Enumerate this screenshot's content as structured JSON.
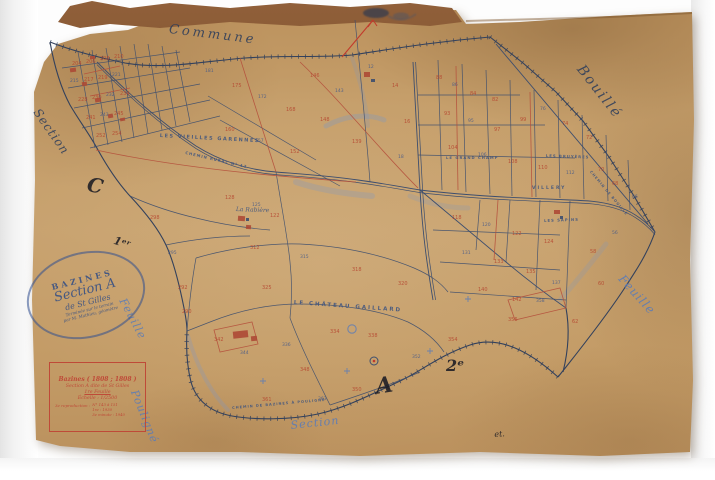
{
  "colors": {
    "paper": "#c49e6a",
    "ink_blue": "#2e3e5c",
    "parcel_blue": "#3d4e6e",
    "ink_red": "#b5503c",
    "pencil_blue": "#5b7cb8",
    "stamp_blue": "#2f4f8f",
    "box_red": "#bf4a38"
  },
  "stamp": {
    "lines": [
      "BAZINES",
      "Section A",
      "de St Gilles",
      "Terminée sur le terrain",
      "par M. Mathieu, géomètre"
    ]
  },
  "cartouche": {
    "line1": "Bazines ( 1808 ; 1808 )",
    "line2": "Section A dite de St Gilles",
    "line3": "1re Feuille",
    "line4": "Échelle : 1/2500",
    "repro_label": "3e reproduction :",
    "repro_lines": [
      "N° 143 à 151",
      "1re : 1930",
      "3e minute : 1940"
    ]
  },
  "map": {
    "labels": [
      {
        "id": "commune",
        "t": "Commune",
        "x": 170,
        "y": 22,
        "r": 7,
        "s": 13,
        "ls": 3,
        "c": "ink",
        "st": "script"
      },
      {
        "id": "bouille",
        "t": "Bouillé",
        "x": 586,
        "y": 62,
        "r": 52,
        "s": 14,
        "ls": 2,
        "c": "ink",
        "st": "script"
      },
      {
        "id": "feuille-right",
        "t": "Feuille",
        "x": 626,
        "y": 272,
        "r": 48,
        "s": 12,
        "ls": 1,
        "c": "pencil",
        "st": "script"
      },
      {
        "id": "section-left",
        "t": "Section",
        "x": 42,
        "y": 106,
        "r": 55,
        "s": 12,
        "ls": 1,
        "c": "ink",
        "st": "script"
      },
      {
        "id": "feuille-left",
        "t": "Feuille",
        "x": 128,
        "y": 296,
        "r": 62,
        "s": 11,
        "ls": 1,
        "c": "pencil",
        "st": "script"
      },
      {
        "id": "pouligne",
        "t": "Pouligné",
        "x": 140,
        "y": 388,
        "r": 68,
        "s": 11,
        "ls": 1,
        "c": "pencil",
        "st": "script"
      },
      {
        "id": "section-bottom",
        "t": "Section",
        "x": 290,
        "y": 419,
        "r": -6,
        "s": 11,
        "ls": 1,
        "c": "pencil",
        "st": "script"
      },
      {
        "id": "letter-c",
        "t": "C",
        "x": 90,
        "y": 172,
        "r": 12,
        "s": 20,
        "ls": 0,
        "c": "dark",
        "st": "big"
      },
      {
        "id": "letter-1er",
        "t": "1ᵉʳ",
        "x": 116,
        "y": 234,
        "r": 18,
        "s": 11,
        "ls": 0,
        "c": "dark",
        "st": "big"
      },
      {
        "id": "letter-a",
        "t": "A",
        "x": 374,
        "y": 374,
        "r": -8,
        "s": 22,
        "ls": 0,
        "c": "dark",
        "st": "big"
      },
      {
        "id": "letter-2e",
        "t": "2ᵉ",
        "x": 446,
        "y": 356,
        "r": 0,
        "s": 16,
        "ls": 0,
        "c": "dark",
        "st": "big"
      },
      {
        "id": "et-mark",
        "t": "et.",
        "x": 494,
        "y": 430,
        "r": -4,
        "s": 8,
        "ls": 0,
        "c": "dark",
        "st": "script"
      },
      {
        "id": "garennes",
        "t": "LES VIEILLES GARENNES",
        "x": 160,
        "y": 133,
        "r": 3,
        "s": 5,
        "ls": 1.5,
        "c": "label",
        "st": "caps"
      },
      {
        "id": "rabiere",
        "t": "La Rabière",
        "x": 236,
        "y": 206,
        "r": 2,
        "s": 6,
        "ls": 0,
        "c": "label",
        "st": "script"
      },
      {
        "id": "chateau",
        "t": "LE CHÂTEAU GAILLARD",
        "x": 294,
        "y": 300,
        "r": 4,
        "s": 5.5,
        "ls": 2,
        "c": "label",
        "st": "caps"
      },
      {
        "id": "chemin-rural",
        "t": "CHEMIN RURAL N° 12",
        "x": 186,
        "y": 150,
        "r": 13,
        "s": 3.8,
        "ls": 1,
        "c": "label",
        "st": "caps"
      },
      {
        "id": "grand-champ",
        "t": "LE GRAND CHAMP",
        "x": 446,
        "y": 155,
        "r": 0,
        "s": 3.8,
        "ls": 1,
        "c": "label",
        "st": "caps"
      },
      {
        "id": "bruyeres",
        "t": "LES BRUYÈRES",
        "x": 546,
        "y": 153,
        "r": 2,
        "s": 3.8,
        "ls": 1,
        "c": "label",
        "st": "caps"
      },
      {
        "id": "villery",
        "t": "VILLERY",
        "x": 532,
        "y": 186,
        "r": 0,
        "s": 4.5,
        "ls": 2,
        "c": "label",
        "st": "caps"
      },
      {
        "id": "sapins",
        "t": "LES SAPINS",
        "x": 544,
        "y": 218,
        "r": -2,
        "s": 3.8,
        "ls": 1,
        "c": "label",
        "st": "caps"
      },
      {
        "id": "chemin-bazines",
        "t": "CHEMIN DE BAZINES À POULIGNÉ",
        "x": 232,
        "y": 406,
        "r": -5,
        "s": 3.5,
        "ls": 1,
        "c": "label",
        "st": "caps"
      },
      {
        "id": "chemin-bouille",
        "t": "CHEMIN DE BOUILLÉ",
        "x": 592,
        "y": 170,
        "r": 50,
        "s": 3.5,
        "ls": 1,
        "c": "label",
        "st": "caps"
      }
    ],
    "parcel_numbers": [
      {
        "x": 72,
        "y": 62,
        "t": "204",
        "c": "r"
      },
      {
        "x": 86,
        "y": 60,
        "t": "206",
        "c": "r"
      },
      {
        "x": 100,
        "y": 57,
        "t": "208",
        "c": "r"
      },
      {
        "x": 114,
        "y": 55,
        "t": "210",
        "c": "r"
      },
      {
        "x": 70,
        "y": 80,
        "t": "215",
        "c": "b"
      },
      {
        "x": 84,
        "y": 78,
        "t": "217",
        "c": "r"
      },
      {
        "x": 98,
        "y": 76,
        "t": "219",
        "c": "r"
      },
      {
        "x": 112,
        "y": 74,
        "t": "221",
        "c": "b"
      },
      {
        "x": 78,
        "y": 98,
        "t": "228",
        "c": "r"
      },
      {
        "x": 92,
        "y": 96,
        "t": "230",
        "c": "r"
      },
      {
        "x": 106,
        "y": 94,
        "t": "232",
        "c": "b"
      },
      {
        "x": 120,
        "y": 92,
        "t": "234",
        "c": "r"
      },
      {
        "x": 86,
        "y": 116,
        "t": "241",
        "c": "r"
      },
      {
        "x": 100,
        "y": 114,
        "t": "243",
        "c": "b"
      },
      {
        "x": 114,
        "y": 112,
        "t": "245",
        "c": "r"
      },
      {
        "x": 96,
        "y": 134,
        "t": "252",
        "c": "r"
      },
      {
        "x": 112,
        "y": 132,
        "t": "254",
        "c": "r"
      },
      {
        "x": 205,
        "y": 70,
        "t": "181",
        "c": "b"
      },
      {
        "x": 232,
        "y": 84,
        "t": "175",
        "c": "r"
      },
      {
        "x": 258,
        "y": 96,
        "t": "172",
        "c": "b"
      },
      {
        "x": 286,
        "y": 108,
        "t": "168",
        "c": "r"
      },
      {
        "x": 225,
        "y": 128,
        "t": "160",
        "c": "r"
      },
      {
        "x": 255,
        "y": 140,
        "t": "157",
        "c": "b"
      },
      {
        "x": 290,
        "y": 150,
        "t": "152",
        "c": "r"
      },
      {
        "x": 320,
        "y": 118,
        "t": "148",
        "c": "r"
      },
      {
        "x": 335,
        "y": 90,
        "t": "143",
        "c": "b"
      },
      {
        "x": 352,
        "y": 140,
        "t": "139",
        "c": "r"
      },
      {
        "x": 310,
        "y": 74,
        "t": "146",
        "c": "r"
      },
      {
        "x": 225,
        "y": 196,
        "t": "128",
        "c": "r"
      },
      {
        "x": 252,
        "y": 204,
        "t": "125",
        "c": "b"
      },
      {
        "x": 270,
        "y": 214,
        "t": "122",
        "c": "r"
      },
      {
        "x": 436,
        "y": 76,
        "t": "88",
        "c": "r"
      },
      {
        "x": 452,
        "y": 84,
        "t": "86",
        "c": "b"
      },
      {
        "x": 470,
        "y": 92,
        "t": "84",
        "c": "r"
      },
      {
        "x": 492,
        "y": 98,
        "t": "82",
        "c": "r"
      },
      {
        "x": 444,
        "y": 112,
        "t": "93",
        "c": "r"
      },
      {
        "x": 468,
        "y": 120,
        "t": "95",
        "c": "b"
      },
      {
        "x": 494,
        "y": 128,
        "t": "97",
        "c": "r"
      },
      {
        "x": 520,
        "y": 118,
        "t": "99",
        "c": "r"
      },
      {
        "x": 540,
        "y": 108,
        "t": "76",
        "c": "b"
      },
      {
        "x": 562,
        "y": 122,
        "t": "74",
        "c": "r"
      },
      {
        "x": 586,
        "y": 136,
        "t": "72",
        "c": "r"
      },
      {
        "x": 448,
        "y": 146,
        "t": "104",
        "c": "r"
      },
      {
        "x": 478,
        "y": 154,
        "t": "106",
        "c": "b"
      },
      {
        "x": 508,
        "y": 160,
        "t": "108",
        "c": "r"
      },
      {
        "x": 538,
        "y": 166,
        "t": "110",
        "c": "r"
      },
      {
        "x": 566,
        "y": 172,
        "t": "112",
        "c": "b"
      },
      {
        "x": 598,
        "y": 168,
        "t": "70",
        "c": "r"
      },
      {
        "x": 612,
        "y": 182,
        "t": "68",
        "c": "r"
      },
      {
        "x": 632,
        "y": 196,
        "t": "66",
        "c": "b"
      },
      {
        "x": 452,
        "y": 216,
        "t": "118",
        "c": "r"
      },
      {
        "x": 482,
        "y": 224,
        "t": "120",
        "c": "b"
      },
      {
        "x": 512,
        "y": 232,
        "t": "122",
        "c": "r"
      },
      {
        "x": 544,
        "y": 240,
        "t": "124",
        "c": "r"
      },
      {
        "x": 462,
        "y": 252,
        "t": "131",
        "c": "b"
      },
      {
        "x": 494,
        "y": 260,
        "t": "133",
        "c": "r"
      },
      {
        "x": 526,
        "y": 270,
        "t": "135",
        "c": "r"
      },
      {
        "x": 552,
        "y": 282,
        "t": "137",
        "c": "b"
      },
      {
        "x": 478,
        "y": 288,
        "t": "140",
        "c": "r"
      },
      {
        "x": 512,
        "y": 298,
        "t": "142",
        "c": "r"
      },
      {
        "x": 590,
        "y": 250,
        "t": "58",
        "c": "r"
      },
      {
        "x": 612,
        "y": 232,
        "t": "56",
        "c": "b"
      },
      {
        "x": 598,
        "y": 282,
        "t": "60",
        "c": "r"
      },
      {
        "x": 572,
        "y": 320,
        "t": "62",
        "c": "r"
      },
      {
        "x": 250,
        "y": 246,
        "t": "312",
        "c": "r"
      },
      {
        "x": 300,
        "y": 256,
        "t": "315",
        "c": "b"
      },
      {
        "x": 352,
        "y": 268,
        "t": "318",
        "c": "r"
      },
      {
        "x": 398,
        "y": 282,
        "t": "320",
        "c": "r"
      },
      {
        "x": 262,
        "y": 286,
        "t": "325",
        "c": "r"
      },
      {
        "x": 330,
        "y": 330,
        "t": "334",
        "c": "r"
      },
      {
        "x": 282,
        "y": 344,
        "t": "336",
        "c": "b"
      },
      {
        "x": 368,
        "y": 334,
        "t": "338",
        "c": "r"
      },
      {
        "x": 214,
        "y": 338,
        "t": "342",
        "c": "r"
      },
      {
        "x": 240,
        "y": 352,
        "t": "344",
        "c": "b"
      },
      {
        "x": 300,
        "y": 368,
        "t": "348",
        "c": "r"
      },
      {
        "x": 352,
        "y": 388,
        "t": "350",
        "c": "r"
      },
      {
        "x": 412,
        "y": 356,
        "t": "352",
        "c": "b"
      },
      {
        "x": 448,
        "y": 338,
        "t": "354",
        "c": "r"
      },
      {
        "x": 508,
        "y": 318,
        "t": "356",
        "c": "r"
      },
      {
        "x": 536,
        "y": 300,
        "t": "358",
        "c": "b"
      },
      {
        "x": 262,
        "y": 398,
        "t": "361",
        "c": "r"
      },
      {
        "x": 318,
        "y": 398,
        "t": "363",
        "c": "b"
      },
      {
        "x": 368,
        "y": 66,
        "t": "12",
        "c": "b"
      },
      {
        "x": 392,
        "y": 84,
        "t": "14",
        "c": "r"
      },
      {
        "x": 404,
        "y": 120,
        "t": "16",
        "c": "r"
      },
      {
        "x": 398,
        "y": 156,
        "t": "18",
        "c": "b"
      },
      {
        "x": 150,
        "y": 216,
        "t": "298",
        "c": "r"
      },
      {
        "x": 168,
        "y": 252,
        "t": "295",
        "c": "b"
      },
      {
        "x": 178,
        "y": 286,
        "t": "292",
        "c": "r"
      },
      {
        "x": 182,
        "y": 310,
        "t": "290",
        "c": "r"
      }
    ]
  }
}
